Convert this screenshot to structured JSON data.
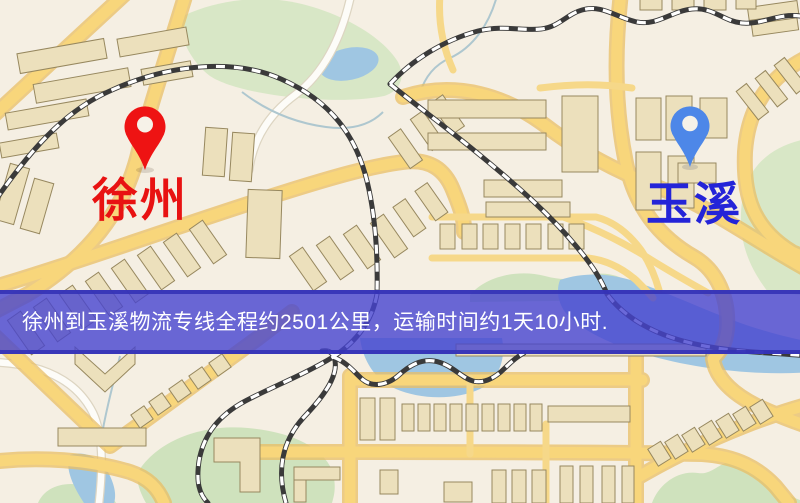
{
  "map": {
    "origin": {
      "label": "徐州",
      "marker_icon": "red-pin-icon"
    },
    "destination": {
      "label": "玉溪",
      "marker_icon": "blue-pin-icon"
    }
  },
  "banner": {
    "text": "徐州到玉溪物流专线全程约2501公里，运输时间约1天10小时."
  },
  "colors": {
    "origin-pin": "#ee1313",
    "origin-label": "#e81212",
    "destination-pin": "#4d87e8",
    "destination-label": "#2424d8",
    "banner-bg": "#4644cf",
    "banner-text": "#ffffff"
  }
}
